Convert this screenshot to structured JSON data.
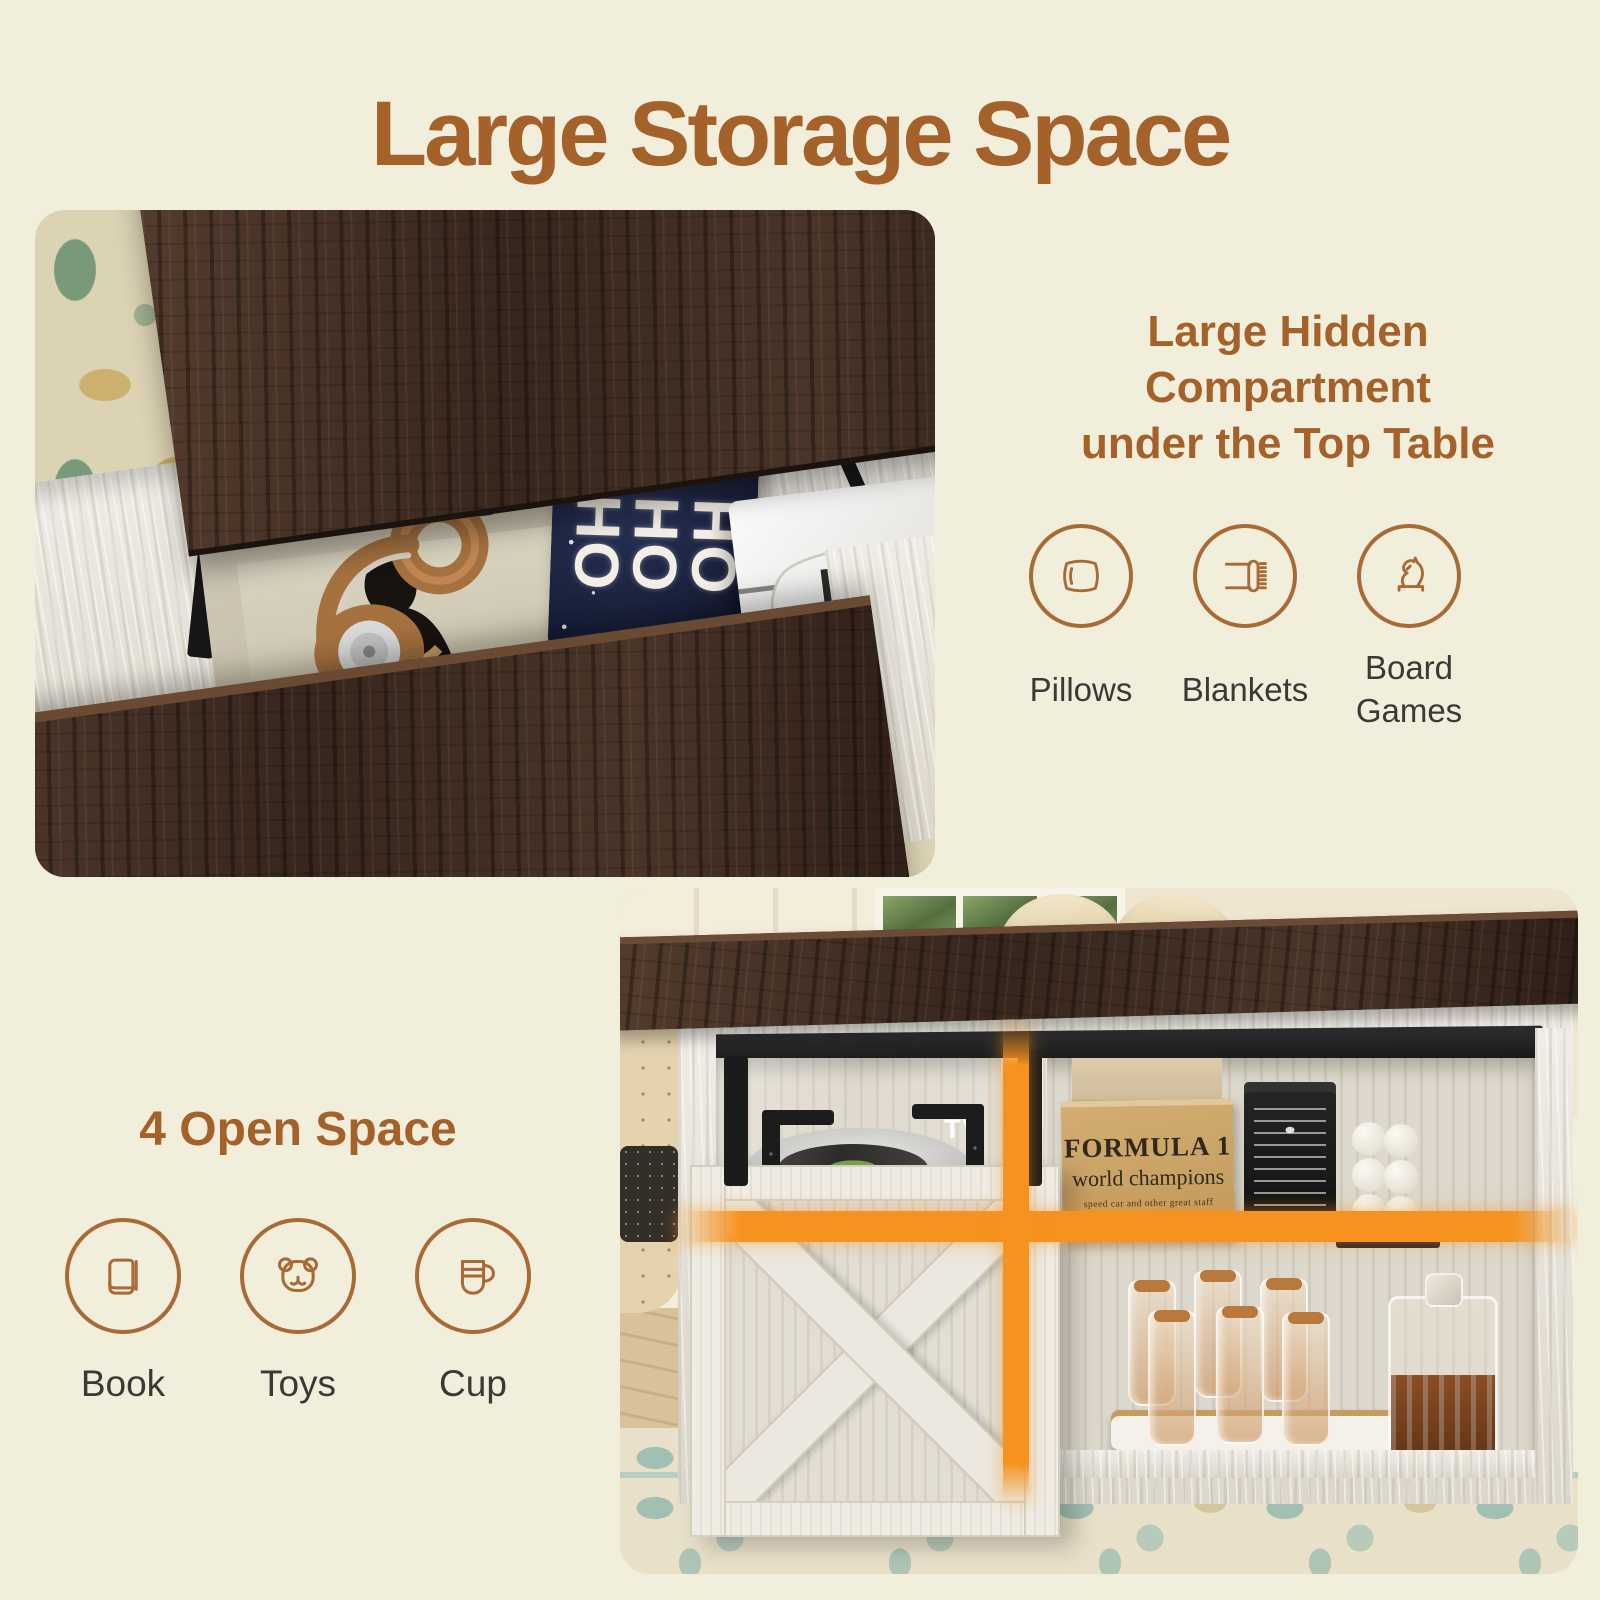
{
  "page": {
    "background": "#f1eedc",
    "accent_brown": "#a5612a",
    "icon_stroke": "#a96a35",
    "label_color": "#3b3936",
    "highlight_orange": "#f6921e"
  },
  "title": "Large Storage Space",
  "hidden_compartment": {
    "heading_lines": [
      "Large Hidden",
      "Compartment",
      "under the Top Table"
    ],
    "features": [
      {
        "icon": "pillow-icon",
        "label": "Pillows"
      },
      {
        "icon": "blanket-icon",
        "label": "Blankets"
      },
      {
        "icon": "chess-knight-icon",
        "label": "Board Games"
      }
    ]
  },
  "open_space": {
    "heading": "4 Open Space",
    "features": [
      {
        "icon": "book-icon",
        "label": "Book"
      },
      {
        "icon": "teddy-bear-icon",
        "label": "Toys"
      },
      {
        "icon": "cup-icon",
        "label": "Cup"
      }
    ]
  },
  "photo_lift_top": {
    "magazine_title": "CEREAL",
    "pillow_text": "HO HO HO"
  },
  "photo_console": {
    "box_title": "FORMULA 1",
    "box_subtitle": "world champions",
    "box_tagline": "speed car and other  great  staff",
    "glass_label": "TV"
  }
}
